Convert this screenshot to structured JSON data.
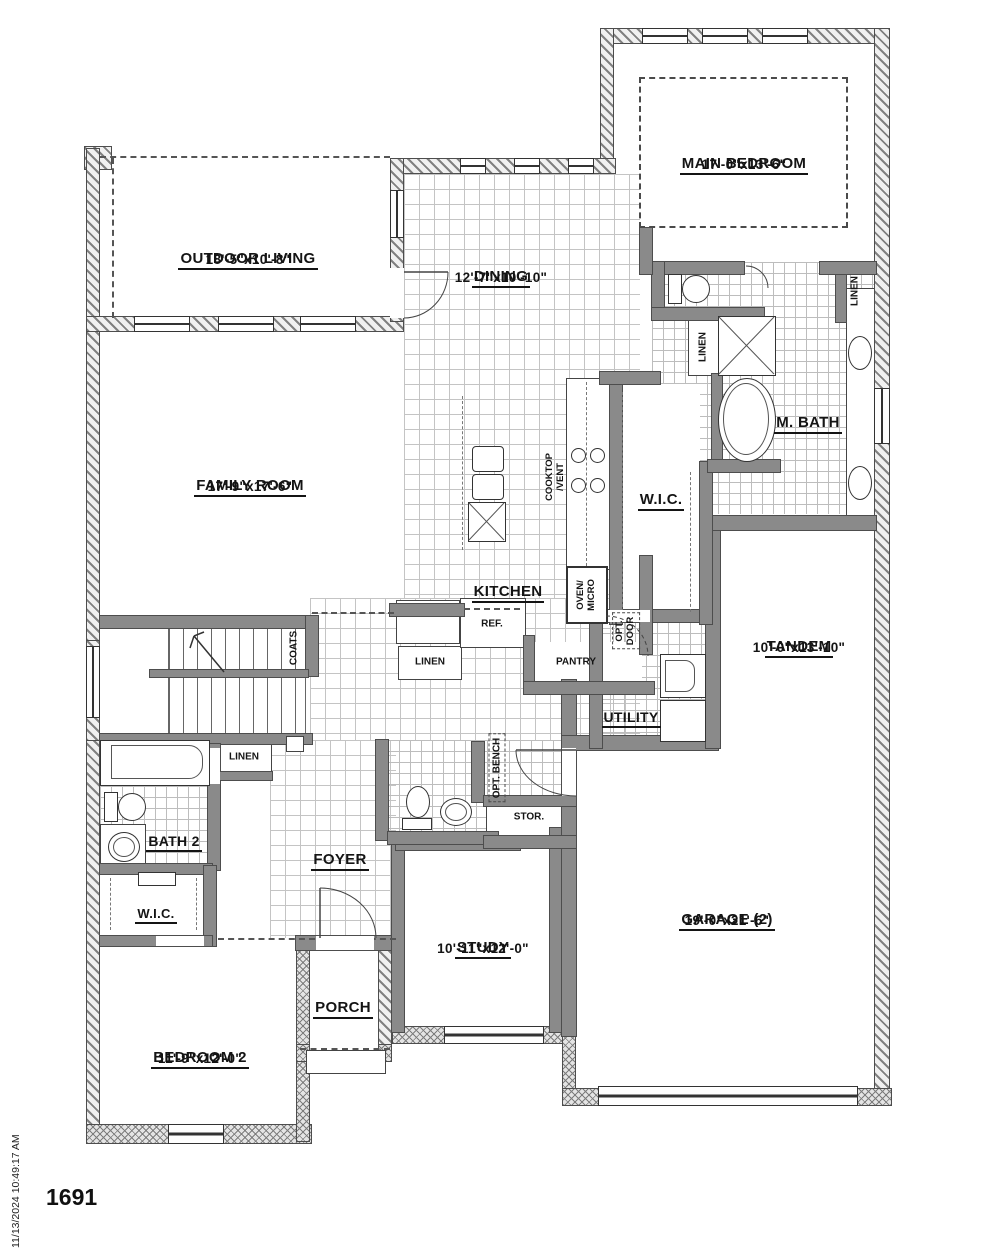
{
  "meta": {
    "plan_number": "1691",
    "timestamp": "11/13/2024 10:49:17 AM"
  },
  "rooms": {
    "main_bedroom": {
      "name": "MAIN BEDROOM",
      "dims": "17'-0\"x13'-6\""
    },
    "outdoor_living": {
      "name": "OUTDOOR LIVING",
      "dims": "18'-5\"x10'-8\""
    },
    "dining": {
      "name": "DINING",
      "dims": "12'-7\"x10'-10\""
    },
    "family_room": {
      "name": "FAMILY ROOM",
      "dims": "17'-9\"x17'-6\""
    },
    "kitchen": {
      "name": "KITCHEN"
    },
    "m_bath": {
      "name": "M. BATH"
    },
    "wic_main": {
      "name": "W.I.C."
    },
    "tandem": {
      "name": "TANDEM",
      "dims": "10'-0\"x13'-10\""
    },
    "utility": {
      "name": "UTILITY"
    },
    "bath2": {
      "name": "BATH 2"
    },
    "foyer": {
      "name": "FOYER"
    },
    "wic2": {
      "name": "W.I.C."
    },
    "bedroom2": {
      "name": "BEDROOM 2",
      "dims": "11'-9\"x12'-0\""
    },
    "porch": {
      "name": "PORCH"
    },
    "study": {
      "name": "STUDY",
      "dims": "10'-11\"x12'-0\""
    },
    "garage": {
      "name": "GARAGE (2)",
      "dims": "19'-0\"x21'-6\""
    }
  },
  "labels": {
    "linen": "LINEN",
    "coats": "COATS",
    "pantry": "PANTRY",
    "ref": "REF.",
    "stor": "STOR.",
    "opt_bench": "OPT. BENCH",
    "opt": "OPT.",
    "door": "DOOR",
    "oven": "OVEN/",
    "micro": "MICRO",
    "cooktop": "COOKTOP",
    "vent": "/VENT"
  }
}
